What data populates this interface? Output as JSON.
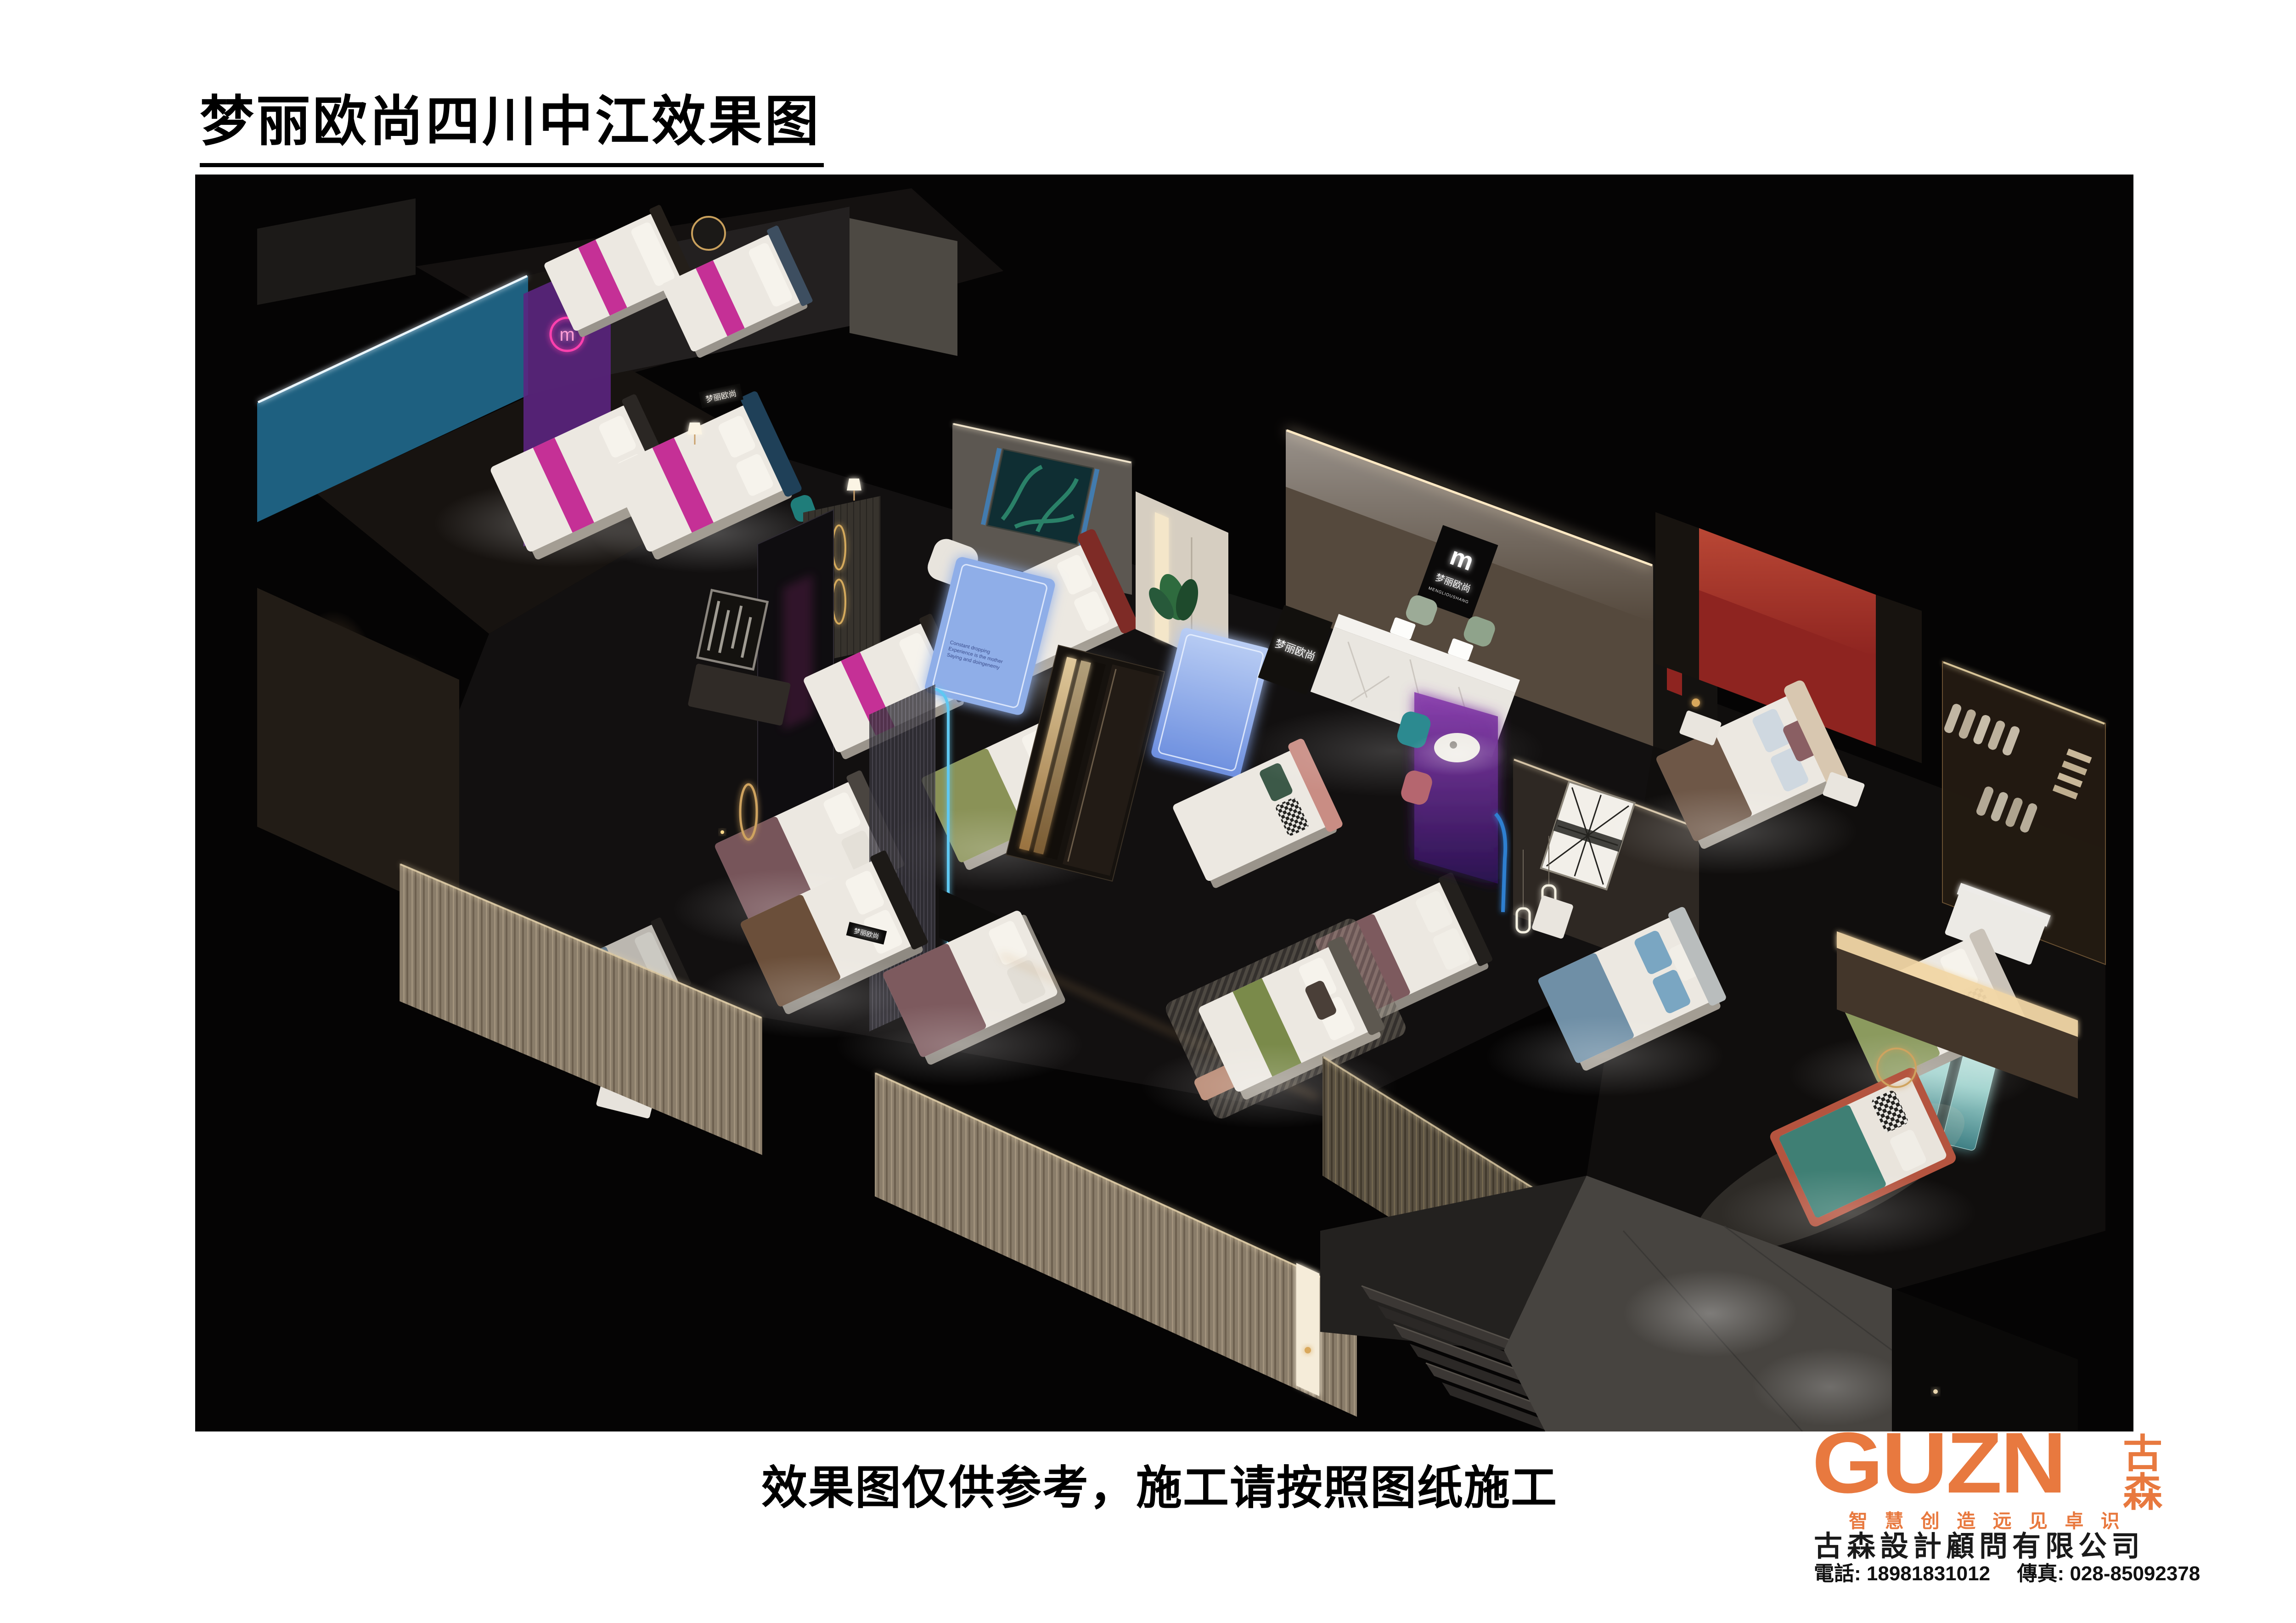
{
  "title": {
    "text": "梦丽欧尚四川中江效果图"
  },
  "disclaimer": {
    "text": "效果图仅供参考，施工请按照图纸施工"
  },
  "brand_logo": {
    "wordmark": "GUZN",
    "wordmark_cn": "古森",
    "tagline": "智 慧 创 造   远 见 卓 识",
    "company": "古森設計顧問有限公司",
    "phone_label": "電話:",
    "phone": "18981831012",
    "fax_label": "傳真:",
    "fax": "028-85092378",
    "accent_color": "#E8793F"
  },
  "render": {
    "signs": {
      "brand_mark": "m",
      "brand_cn": "梦丽欧尚",
      "brand_en": "MENGLIOUSHANG",
      "lightbox_lines": [
        "Constant dropping",
        "Experience is the mother",
        "Saying and doingenemy"
      ]
    },
    "colors": {
      "canvas": "#050404",
      "blue_wall": "#1E6080",
      "lightbox_blue": "#8FAEE8",
      "magenta": "#C11F8F",
      "purple_glass": "#5B2580",
      "red_wall": "#8E2420",
      "stone_wall": "#55493D",
      "marble": "#E9E6E0",
      "mattress": "#ECE8E1",
      "sage_green": "#8A9257",
      "teal_blanket": "#3F7F74",
      "coral": "#B4543F",
      "warm_led": "#F2D7A6",
      "led_blue": "#5FC8F2",
      "curtain": "#8F8272",
      "gold": "#C9A05C"
    }
  }
}
